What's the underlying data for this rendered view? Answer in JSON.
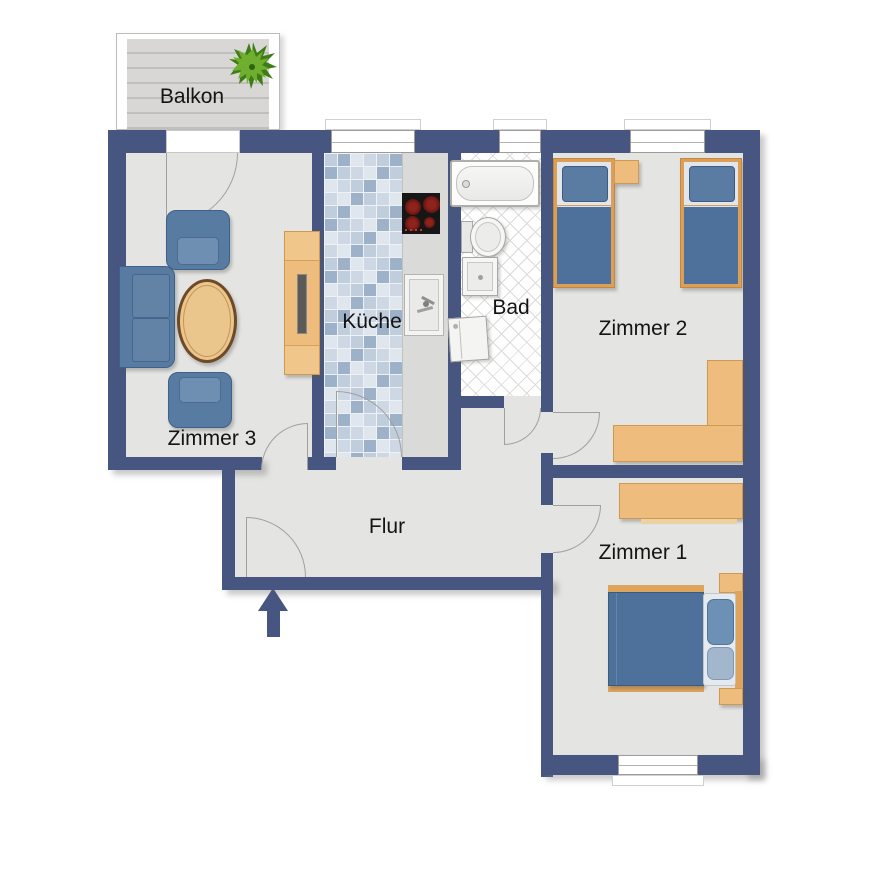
{
  "rooms": {
    "balkon": {
      "label": "Balkon"
    },
    "zimmer3": {
      "label": "Zimmer 3"
    },
    "kueche": {
      "label": "Küche"
    },
    "bad": {
      "label": "Bad"
    },
    "zimmer2": {
      "label": "Zimmer 2"
    },
    "flur": {
      "label": "Flur"
    },
    "zimmer1": {
      "label": "Zimmer 1"
    }
  },
  "colors": {
    "wall": "#475680",
    "room_floor": "#e4e4e2",
    "kitchen_tile_dark": "#9db1c8",
    "kitchen_tile_light": "#bfcddc",
    "bathroom_floor": "#fefefe",
    "balcony_deck": "#d8d7d5",
    "wood_furniture": "#eebc7c",
    "upholstery_blue": "#587ba1",
    "bed_duvet_blue": "#4d719a",
    "stove_black": "#161616",
    "burner_red": "#7a1a15",
    "plant_green": "#5a9922",
    "entrance_arrow": "#475680"
  },
  "icons": {
    "plant_icon": "potted plant",
    "entrance_arrow_icon": "↑"
  }
}
